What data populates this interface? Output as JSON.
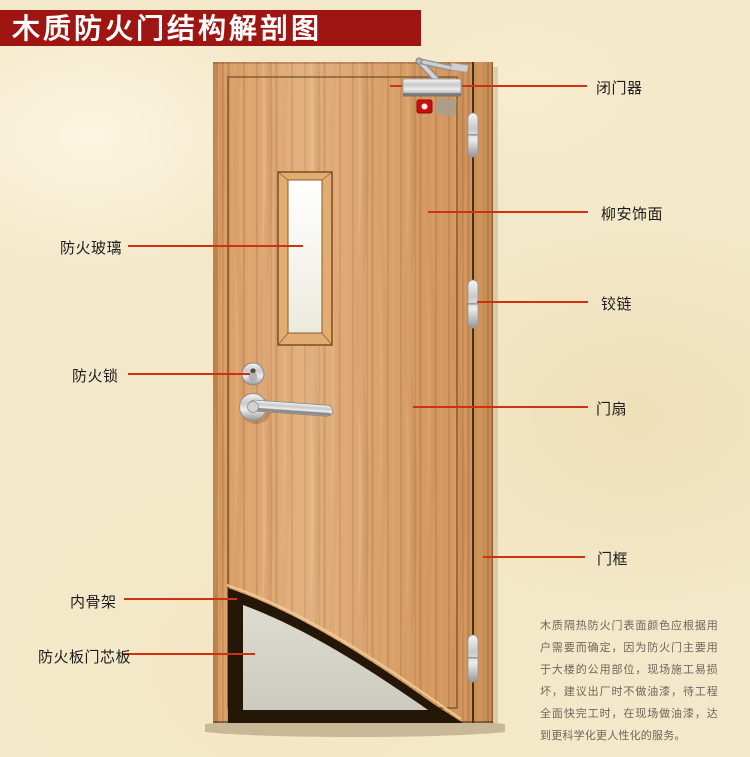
{
  "title": "木质防火门结构解剖图",
  "callouts": {
    "left": [
      {
        "id": "fireproof-glass",
        "text": "防火玻璃"
      },
      {
        "id": "fire-lock",
        "text": "防火锁"
      },
      {
        "id": "inner-skeleton",
        "text": "内骨架"
      },
      {
        "id": "core-board",
        "text": "防火板门芯板"
      }
    ],
    "right": [
      {
        "id": "door-closer",
        "text": "闭门器"
      },
      {
        "id": "lauan-veneer",
        "text": "柳安饰面"
      },
      {
        "id": "hinge",
        "text": "铰链"
      },
      {
        "id": "door-leaf",
        "text": "门扇"
      },
      {
        "id": "door-frame",
        "text": "门框"
      }
    ]
  },
  "description": "木质隔热防火门表面颜色应根据用户需要而确定，因为防火门主要用于大楼的公用部位，现场施工易损坏，建议出厂时不做油漆，待工程全面快完工时，在现场做油漆，达到更科学化更人性化的服务。",
  "colors": {
    "banner": "#9e1511",
    "pointer_line": "#d2310f",
    "door_wood": "#d89d66",
    "frame_wood": "#c78e55",
    "core_grey": "#d7d4c9",
    "skeleton_dark": "#241708",
    "background": "#f3e8c9",
    "description_text": "#6e675c"
  },
  "icons": {
    "door_closer": "door-closer-device",
    "hinges": "hinge-capsules",
    "lock": "lever-handle-and-cylinder",
    "glass": "vision-panel"
  }
}
